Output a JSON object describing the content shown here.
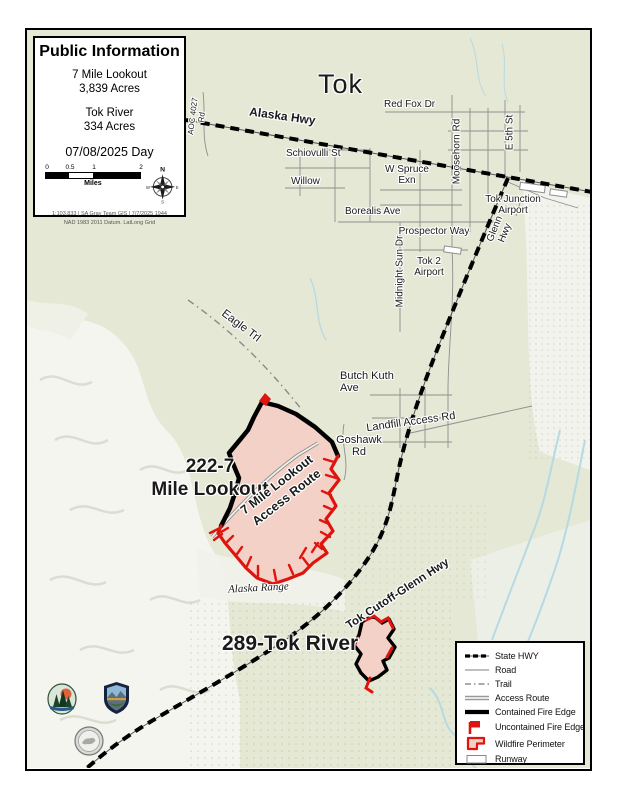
{
  "title_box": {
    "title": "Public Information",
    "fire1_name": "7 Mile Lookout",
    "fire1_acres": "3,839 Acres",
    "fire2_name": "Tok River",
    "fire2_acres": "334 Acres",
    "date_label": "07/08/2025 Day",
    "scale_ticks": [
      "0",
      "0.5",
      "1",
      "2"
    ],
    "scale_unit": "Miles",
    "credit_line1": "1:103,833 | SA Gray Team GIS | 7/7/2025 1944",
    "credit_line2": "NAD 1983 2011 Datum. LatLong Grid",
    "compass": {
      "n": "N",
      "e": "E",
      "s": "S",
      "w": "W"
    }
  },
  "map": {
    "town": "Tok",
    "labels": {
      "alaska_hwy": "Alaska Hwy",
      "red_fox_dr": "Red Fox Dr",
      "moosehorn_rd": "Moosehorn Rd",
      "e_5th_st": "E 5th St",
      "schiovulli_st": "Schiovulli St",
      "willow": "Willow",
      "w_spruce_exn": "W Spruce Exn",
      "borealis_ave": "Borealis Ave",
      "prospector_way": "Prospector Way",
      "midnight_sun_dr": "Midnight Sun Dr",
      "glenn_hwy": "Glenn Hwy",
      "tok_junction_airport": "Tok Junction Airport",
      "tok_2_airport": "Tok 2 Airport",
      "eagle_trl": "Eagle Trl",
      "butch_kuth_ave": "Butch Kuth Ave",
      "landfill_access_rd": "Landfill Access Rd",
      "goshawk_rd": "Goshawk Rd",
      "road_4027": "AOC 4027 Rd",
      "alaska_range": "Alaska Range",
      "tok_cutoff_glenn_hwy": "Tok Cutoff-Glenn Hwy",
      "access_route_line1": "7 Mile Lookout",
      "access_route_line2": "Access Route",
      "fire1_line1": "222-7",
      "fire1_line2": "Mile Lookout",
      "fire2_label": "289-Tok River"
    }
  },
  "legend": {
    "items": [
      {
        "label": "State HWY",
        "symbol": "state-hwy"
      },
      {
        "label": "Road",
        "symbol": "road"
      },
      {
        "label": "Trail",
        "symbol": "trail"
      },
      {
        "label": "Access Route",
        "symbol": "access-route"
      },
      {
        "label": "Contained Fire Edge",
        "symbol": "contained-fire-edge"
      },
      {
        "label": "Uncontained Fire Edge",
        "symbol": "uncontained-fire-edge"
      },
      {
        "label": "Wildfire Perimeter",
        "symbol": "wildfire-perimeter"
      },
      {
        "label": "Runway",
        "symbol": "runway"
      }
    ]
  },
  "colors": {
    "map_background": "#e4e8d5",
    "wildfire_fill": "#f4d1c6",
    "uncontained_red": "#e0140e",
    "contained_black": "#000000",
    "road_gray": "#8f8f8f",
    "water_blue": "#b7dae2",
    "terrain_white": "#f6f6f1"
  }
}
